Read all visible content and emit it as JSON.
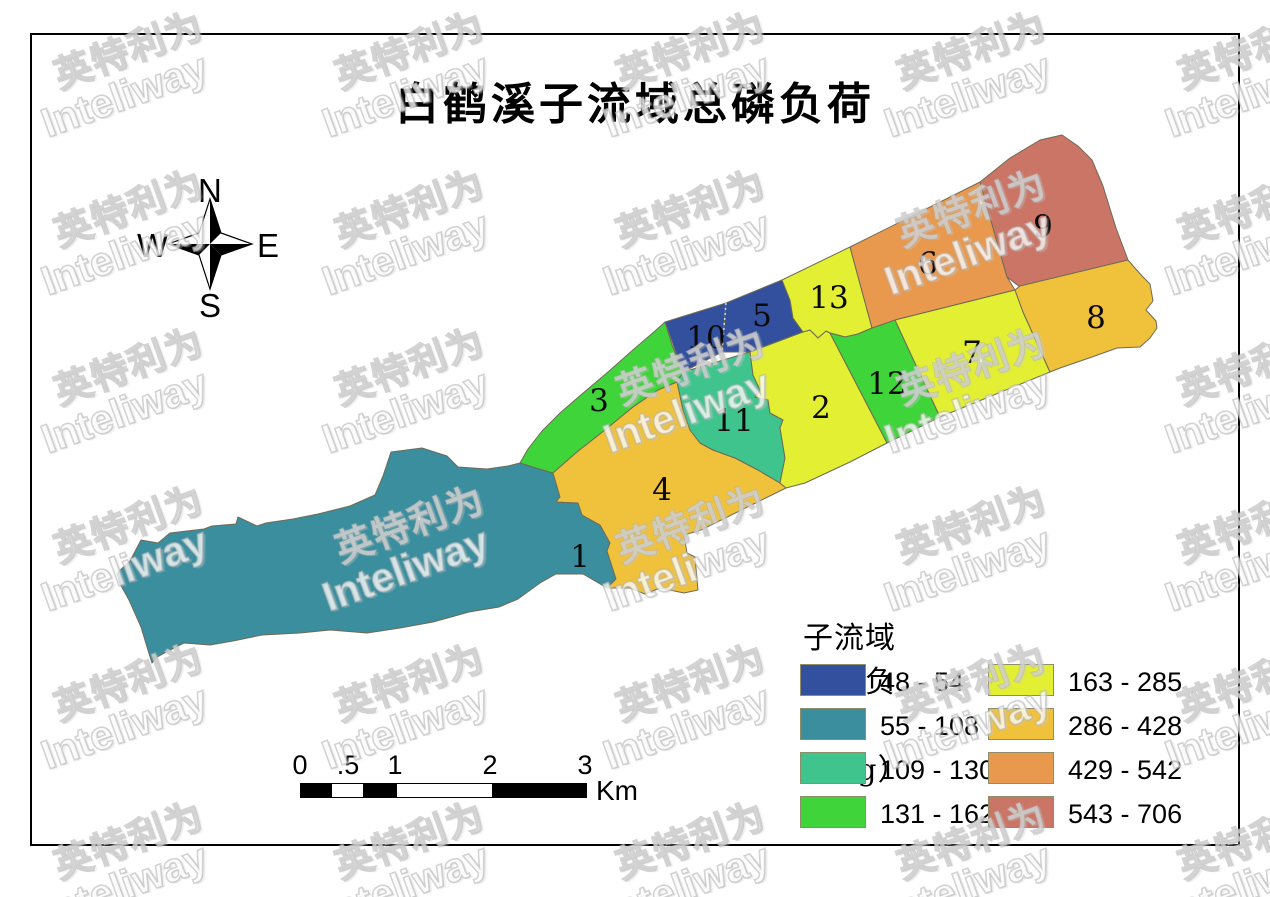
{
  "title": "白鹤溪子流域总磷负荷",
  "compass": {
    "north": "N",
    "south": "S",
    "east": "E",
    "west": "W"
  },
  "scalebar": {
    "unit": "Km",
    "ticks": [
      {
        "label": "0",
        "x": 300
      },
      {
        "label": ".5",
        "x": 348
      },
      {
        "label": "1",
        "x": 395
      },
      {
        "label": "2",
        "x": 490
      },
      {
        "label": "3",
        "x": 585
      }
    ],
    "segments": [
      {
        "from": 0,
        "to": 31,
        "fill": "#000000"
      },
      {
        "from": 31,
        "to": 62,
        "fill": "#ffffff"
      },
      {
        "from": 62,
        "to": 96,
        "fill": "#000000"
      },
      {
        "from": 96,
        "to": 191,
        "fill": "#ffffff"
      },
      {
        "from": 191,
        "to": 285,
        "fill": "#000000"
      }
    ]
  },
  "legend": {
    "title": "子流域总磷负荷（Kg）",
    "items": [
      {
        "range": "48 - 54",
        "color": "#32509d",
        "col": 0,
        "row": 0
      },
      {
        "range": "55 - 108",
        "color": "#3b8e9e",
        "col": 0,
        "row": 1
      },
      {
        "range": "109 - 130",
        "color": "#40c48e",
        "col": 0,
        "row": 2
      },
      {
        "range": "131 - 162",
        "color": "#3fd53a",
        "col": 0,
        "row": 3
      },
      {
        "range": "163 - 285",
        "color": "#e2ef33",
        "col": 1,
        "row": 0
      },
      {
        "range": "286 - 428",
        "color": "#f0c13b",
        "col": 1,
        "row": 1
      },
      {
        "range": "429 - 542",
        "color": "#e8994d",
        "col": 1,
        "row": 2
      },
      {
        "range": "543 - 706",
        "color": "#ca7565",
        "col": 1,
        "row": 3
      }
    ]
  },
  "map": {
    "border_color": "#6e6a55",
    "divider": {
      "x1": 726,
      "y1": 303,
      "x2": 722,
      "y2": 352,
      "color": "#dde3ef"
    },
    "regions": [
      {
        "id": "1",
        "label": "1",
        "range": "55 - 108",
        "color": "#3b8e9e",
        "label_x": 580,
        "label_y": 557,
        "points": "117,573 130,561 141,540 158,543 170,533 204,529 212,526 236,524 238,517 257,526 266,523 293,519 318,514 350,506 375,495 383,476 391,452 422,448 447,456 458,467 487,469 508,466 520,463 536,468 553,473 560,497 556,502 578,503 582,515 600,525 610,543 607,551 616,579 607,588 583,574 556,574 540,583 518,599 499,607 469,612 433,622 400,628 367,633 330,630 300,633 262,635 233,641 210,645 184,643 168,651 157,657 152,663 147,647 141,627 129,600 120,584"
      },
      {
        "id": "3",
        "label": "3",
        "range": "131 - 162",
        "color": "#3fd53a",
        "label_x": 599,
        "label_y": 401,
        "points": "520,463 528,449 542,431 560,413 582,394 608,372 634,349 655,331 665,322 672,345 679,362 683,372 677,382 658,390 633,407 605,430 577,452 553,473 536,468"
      },
      {
        "id": "4",
        "label": "4",
        "range": "286 - 428",
        "color": "#f0c13b",
        "label_x": 662,
        "label_y": 490,
        "points": "553,473 577,452 605,430 633,407 658,390 677,382 679,391 683,410 690,430 700,443 713,450 735,458 758,470 780,483 786,488 701,530 684,535 687,553 695,557 698,590 684,593 660,588 645,594 630,588 607,588 616,579 607,551 610,543 600,525 582,515 578,503 556,502 560,497"
      },
      {
        "id": "11",
        "label": "11",
        "range": "109 - 130",
        "color": "#40c48e",
        "label_x": 734,
        "label_y": 421,
        "points": "683,372 750,352 753,375 760,390 755,397 768,400 770,413 783,420 780,428 785,458 780,483 758,470 735,458 713,450 700,443 690,430 683,410 679,391 677,382"
      },
      {
        "id": "10",
        "label": "10",
        "range": "48 - 54",
        "color": "#32509d",
        "label_x": 706,
        "label_y": 338,
        "points": "665,322 726,303 722,352 683,372"
      },
      {
        "id": "5",
        "label": "5",
        "range": "48 - 54",
        "color": "#32509d",
        "label_x": 762,
        "label_y": 316,
        "points": "726,303 782,280 790,300 793,318 803,332 750,352 722,352"
      },
      {
        "id": "2",
        "label": "2",
        "range": "163 - 285",
        "color": "#e2ef33",
        "label_x": 821,
        "label_y": 408,
        "points": "750,352 803,332 810,330 818,338 826,331 830,333 887,443 850,462 805,483 786,488 780,483 785,458 780,428 783,420 770,413 768,400 755,397 760,390 753,375"
      },
      {
        "id": "13",
        "label": "13",
        "range": "163 - 285",
        "color": "#e2ef33",
        "label_x": 829,
        "label_y": 298,
        "points": "782,280 850,247 872,328 858,334 845,337 830,333 826,331 818,338 810,330 803,332 793,318 790,300"
      },
      {
        "id": "12",
        "label": "12",
        "range": "131 - 162",
        "color": "#3fd53a",
        "label_x": 887,
        "label_y": 384,
        "points": "830,333 845,337 858,334 872,328 895,320 940,417 887,443"
      },
      {
        "id": "6",
        "label": "6",
        "range": "429 - 542",
        "color": "#e8994d",
        "label_x": 928,
        "label_y": 264,
        "points": "850,247 980,182 1007,277 1015,290 895,320 872,328"
      },
      {
        "id": "7",
        "label": "7",
        "range": "163 - 285",
        "color": "#e2ef33",
        "label_x": 972,
        "label_y": 353,
        "points": "895,320 1015,290 1023,312 1050,372 940,417"
      },
      {
        "id": "9",
        "label": "9",
        "range": "543 - 706",
        "color": "#ca7565",
        "label_x": 1043,
        "label_y": 227,
        "points": "980,182 1010,158 1040,140 1062,135 1078,146 1092,160 1103,186 1116,228 1128,260 1020,287 1007,277"
      },
      {
        "id": "8",
        "label": "8",
        "range": "286 - 428",
        "color": "#f0c13b",
        "label_x": 1096,
        "label_y": 318,
        "points": "1015,290 1020,286 1128,260 1134,267 1143,277 1150,284 1153,301 1146,310 1156,321 1157,328 1150,338 1140,347 1117,348 1092,357 1060,368 1050,372 1023,312"
      }
    ]
  },
  "watermark": {
    "text_cn": "英特利为",
    "text_en": "Inteliway"
  }
}
